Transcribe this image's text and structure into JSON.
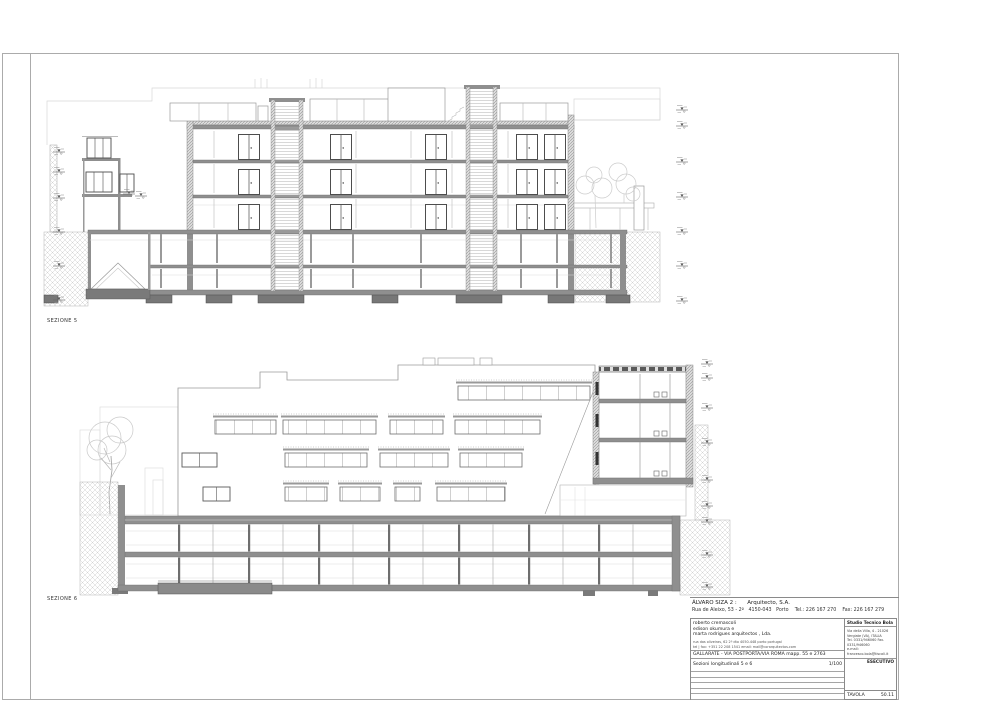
{
  "page": {
    "background": "#ffffff",
    "frame_color": "#ababab",
    "wall_color": "#8f8f8f",
    "footing_color": "#777777"
  },
  "labels": {
    "section_top": "SEZIONE 5",
    "section_bottom": "SEZIONE 6"
  },
  "title_block": {
    "architect_line": "ÁLVARO SIZA 2 :      Arquitecto, S.A.",
    "architect_address": "Rua de Aleixo, 53 - 2º   4150-043   Porto    Tel.: 226 167 270    Fax: 226 167 279",
    "collaborator_1": "roberto cremascoli",
    "collaborator_2": "edison  okumura  e",
    "collaborator_3": "marta  rodrigues  arquitectos , Lda.",
    "collaborator_address": "rua das oliveiras, 62 2º dto   4050-448   porto   portugal",
    "collaborator_contact": "tel | fax: +351 22 208 1541    email: mail@corarquitectos.com",
    "project": "GALLARATE - VIA POSTPORTA/VIA ROMA mapp. 55 e 2763",
    "drawing_title": "Sezioni longitudinali  5 e 6",
    "scale": "1/100",
    "studio_name": "Studio Tecnico Bola",
    "studio_address_1": "Via della Villa, 4 - 21026",
    "studio_address_2": "Vergiate (VA), ITALIA",
    "studio_phone": "Tel. 0331/946060  Fax. 0331/946060",
    "studio_email": "e-mail: francesco.bola@tiscali.it",
    "phase": "ESECUTIVO",
    "tavola_label": "TAVOLA",
    "tavola_number": "50.11"
  }
}
